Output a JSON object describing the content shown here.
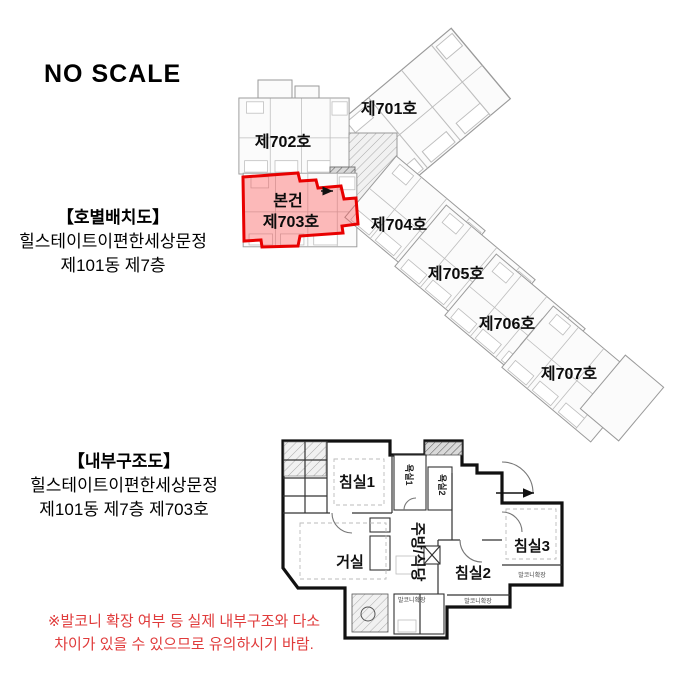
{
  "title_note": {
    "no_scale": "NO SCALE"
  },
  "unit_layout": {
    "section_title": "【호별배치도】",
    "complex_name": "힐스테이트이편한세상문정",
    "location": "제101동 제7층",
    "subject_marker": "본건",
    "units": [
      {
        "label": "제701호"
      },
      {
        "label": "제702호"
      },
      {
        "label": "제703호"
      },
      {
        "label": "제704호"
      },
      {
        "label": "제705호"
      },
      {
        "label": "제706호"
      },
      {
        "label": "제707호"
      }
    ]
  },
  "floor_plan": {
    "section_title": "【내부구조도】",
    "complex_name": "힐스테이트이편한세상문정",
    "location": "제101동 제7층 제703호",
    "rooms": {
      "bedroom1": "침실1",
      "bedroom2": "침실2",
      "bedroom3": "침실3",
      "living": "거실",
      "kitchen": "주방/식당",
      "bath1": "욕실1",
      "bath2": "욕실2",
      "balcony_ext": "발코니확장"
    }
  },
  "warning": {
    "line1": "※발코니 확장 여부 등 실제 내부구조와 다소",
    "line2": "차이가 있을 수 있으므로 유의하시기 바람."
  },
  "colors": {
    "highlight_stroke": "#e80000",
    "highlight_fill": "#f08080",
    "warning_text": "#e03b3b",
    "drawing_line": "#9a9a9a"
  }
}
